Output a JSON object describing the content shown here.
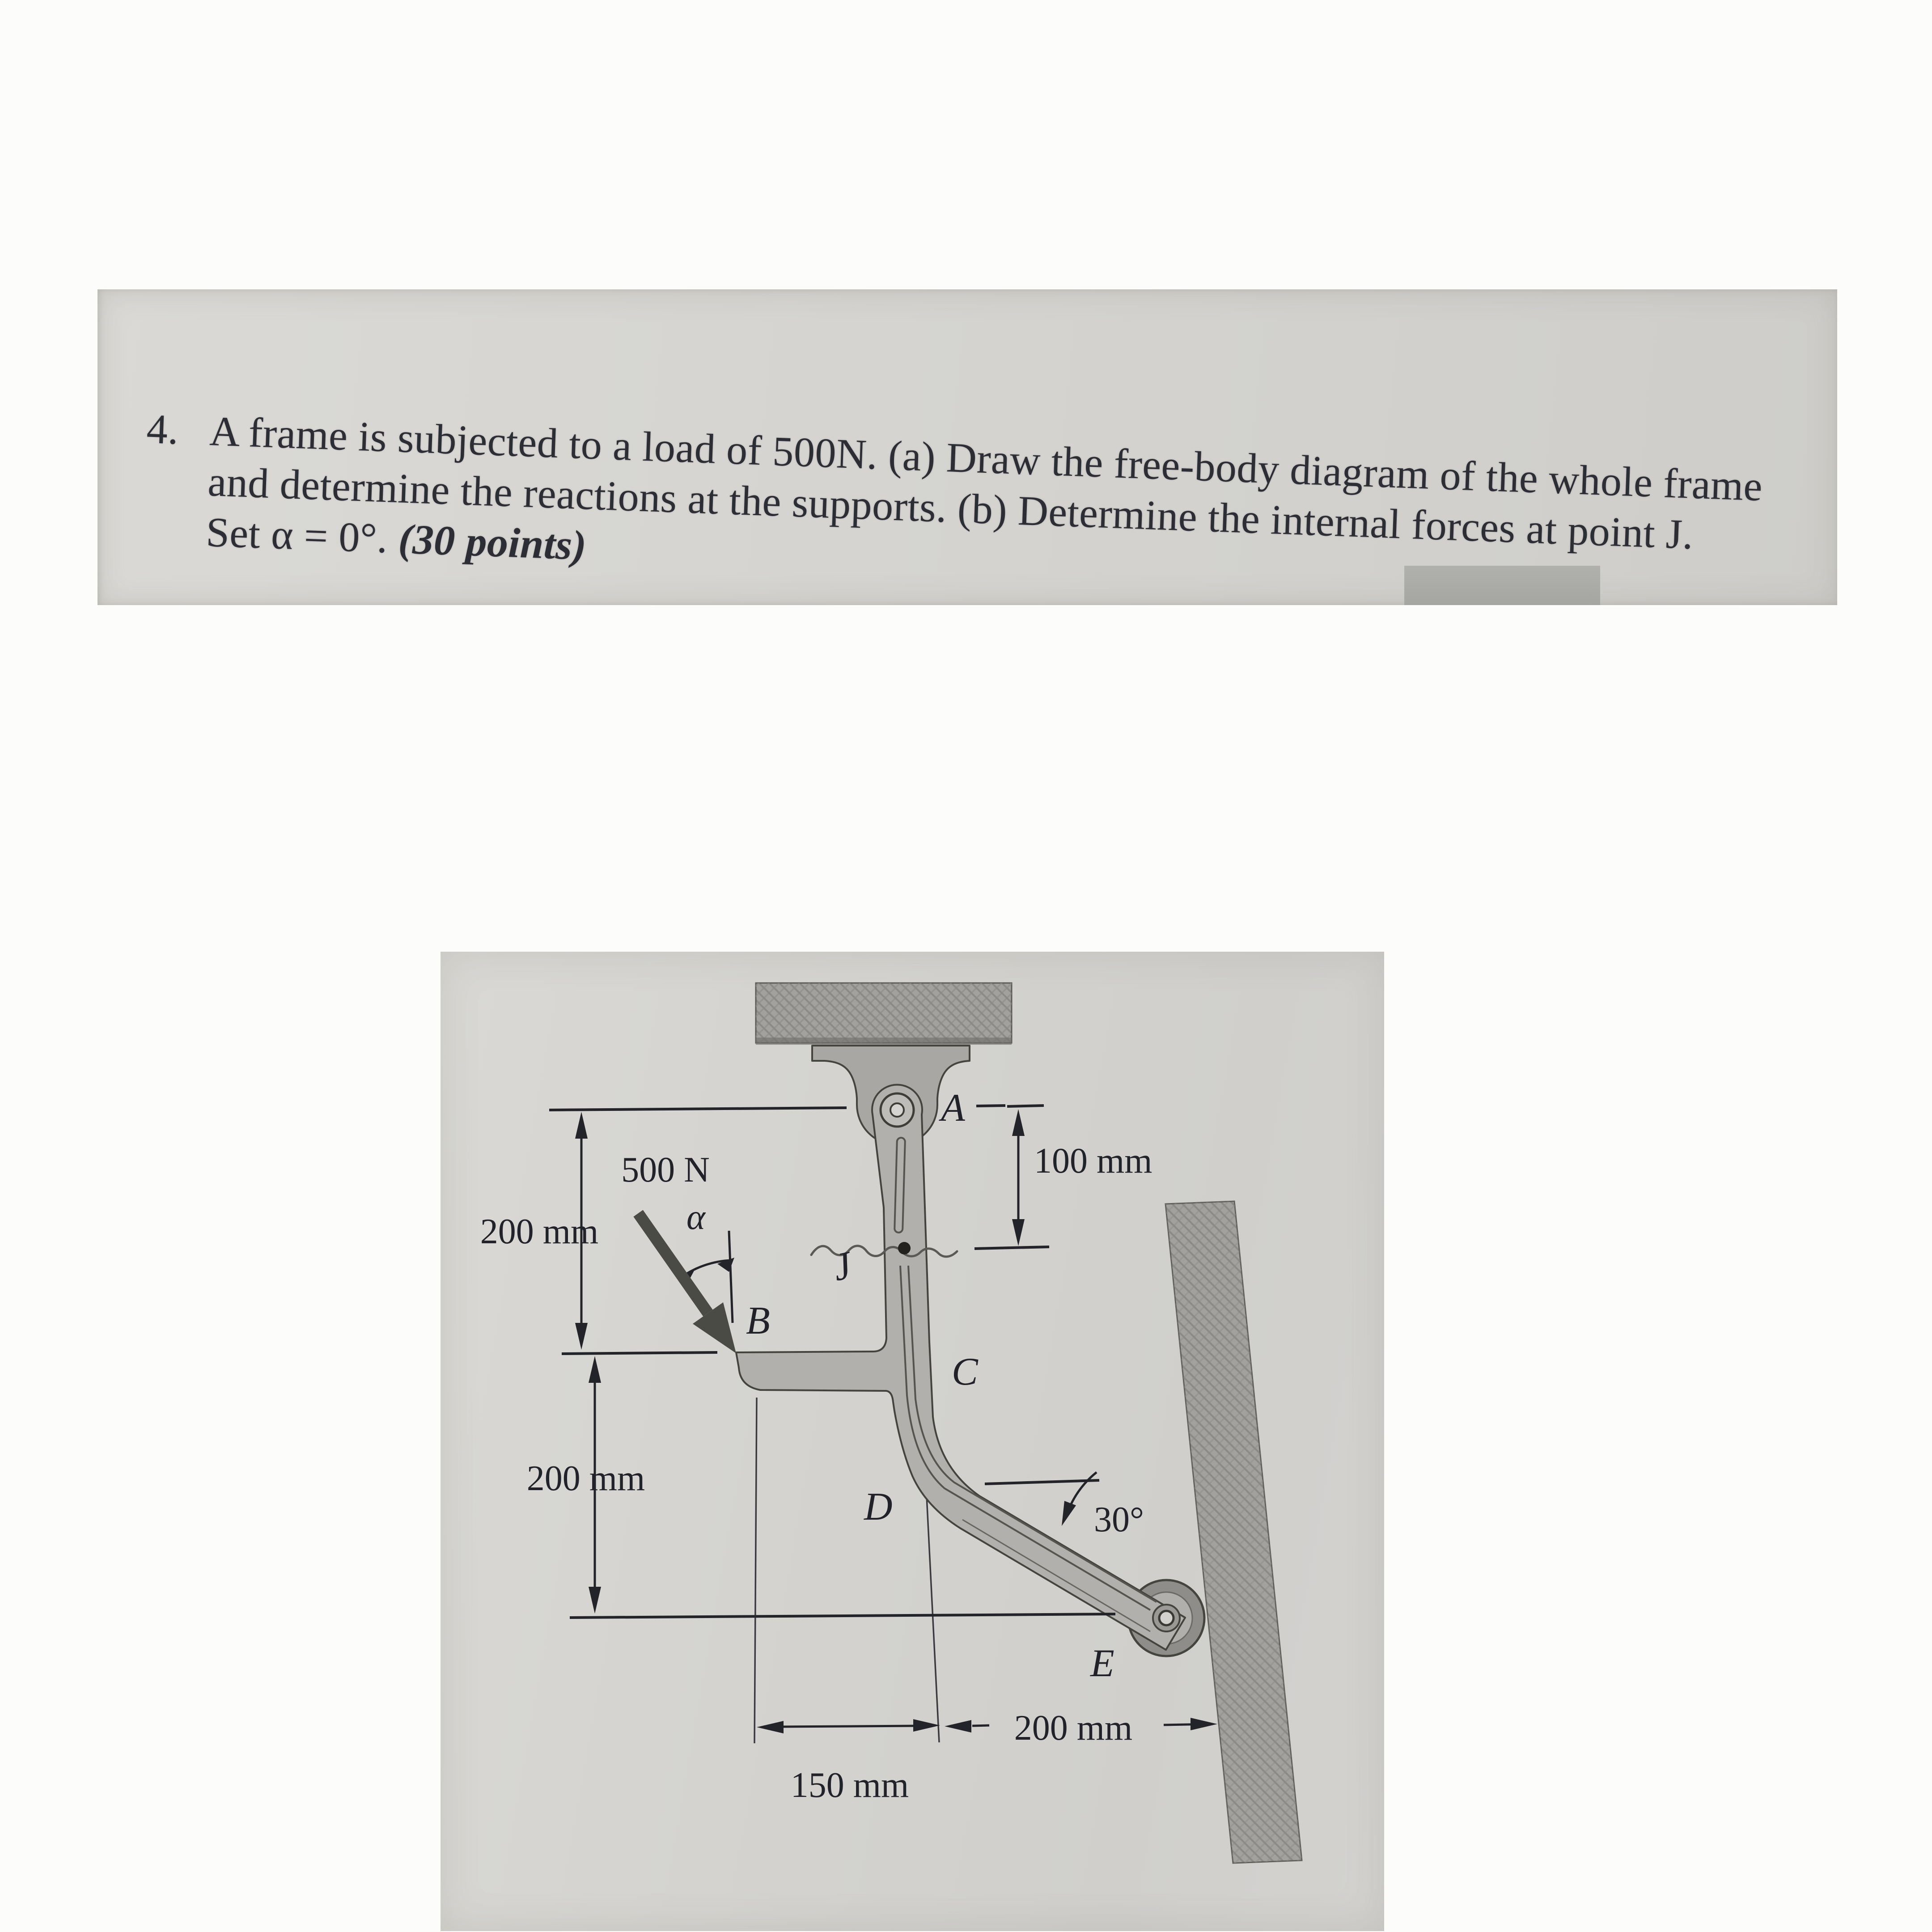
{
  "problem": {
    "number": "4.",
    "line1": "A frame is subjected to a load of 500N. (a) Draw the free-body diagram of the whole frame",
    "line2": "and determine the reactions at the supports. (b) Determine the internal forces at point J.",
    "line3_normal": "Set α = 0°. ",
    "line3_bold": "(30 points)"
  },
  "figure": {
    "load": "500 N",
    "alpha": "α",
    "angle": "30°",
    "labels": {
      "A": "A",
      "B": "B",
      "C": "C",
      "D": "D",
      "E": "E",
      "J": "J"
    },
    "dims": {
      "top": "100 mm",
      "upper_left": "200 mm",
      "lower_left": "200 mm",
      "bottom_center": "150 mm",
      "bottom_right": "200 mm"
    }
  },
  "colors": {
    "paper_strip": "#d6d5d1",
    "photo_paper": "#d3d2ce",
    "member_fill": "#b1b0ac",
    "hatch_fill": "#a2a19d",
    "ink": "#22222a",
    "force_arrow": "#4b4b46"
  }
}
